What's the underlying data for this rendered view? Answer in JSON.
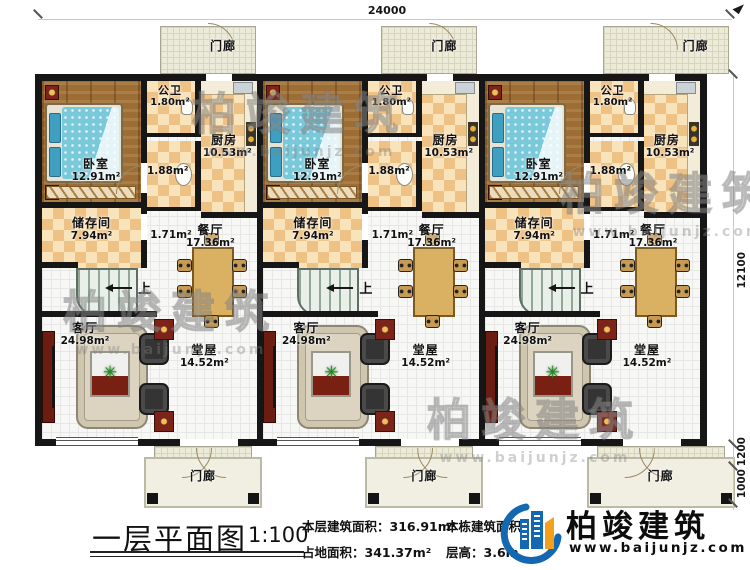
{
  "dimensions": {
    "top_width": "24000",
    "right_height": "12100",
    "porch_depth": "1200",
    "step_depth": "1000"
  },
  "rooms": {
    "porch": {
      "name": "门廊"
    },
    "bedroom": {
      "name": "卧室",
      "area": "12.91m²"
    },
    "toilet": {
      "name": "公卫",
      "area": "1.80m²"
    },
    "wash": {
      "area": "1.88m²"
    },
    "corridor": {
      "area": "1.71m²"
    },
    "kitchen": {
      "name": "厨房",
      "area": "10.53m²"
    },
    "storage": {
      "name": "储存间",
      "area": "7.94m²"
    },
    "dining": {
      "name": "餐厅",
      "area": "17.36m²"
    },
    "living": {
      "name": "客厅",
      "area": "24.98m²"
    },
    "hall": {
      "name": "堂屋",
      "area": "14.52m²"
    },
    "stairs": {
      "label": "上"
    }
  },
  "title_block": {
    "title": "一层平面图",
    "scale": "1:100",
    "stats_col1": [
      {
        "label": "本层建筑面积：",
        "value": "316.91m²"
      },
      {
        "label": "占地面积：",
        "value": "341.37m²"
      }
    ],
    "stats_col2": [
      {
        "label": "本栋建筑面积：",
        "value": "6"
      },
      {
        "label": "层高：",
        "value": "3.6m"
      }
    ]
  },
  "logo": {
    "name": "柏竣建筑",
    "url": "www.baijunjz.com"
  },
  "watermark": {
    "text": "柏竣建筑",
    "url": "www.baijunjz.com"
  },
  "colors": {
    "wall": "#161616",
    "checker_dark": "#eec184",
    "checker_light": "#f8e3ba",
    "wood_floor": "#9c6d35",
    "porch_floor": "#ecead9",
    "bed_blue": "#79c9da",
    "maroon": "#7c241a",
    "logo_blue": "#1468b2",
    "logo_orange": "#f5a01a"
  }
}
